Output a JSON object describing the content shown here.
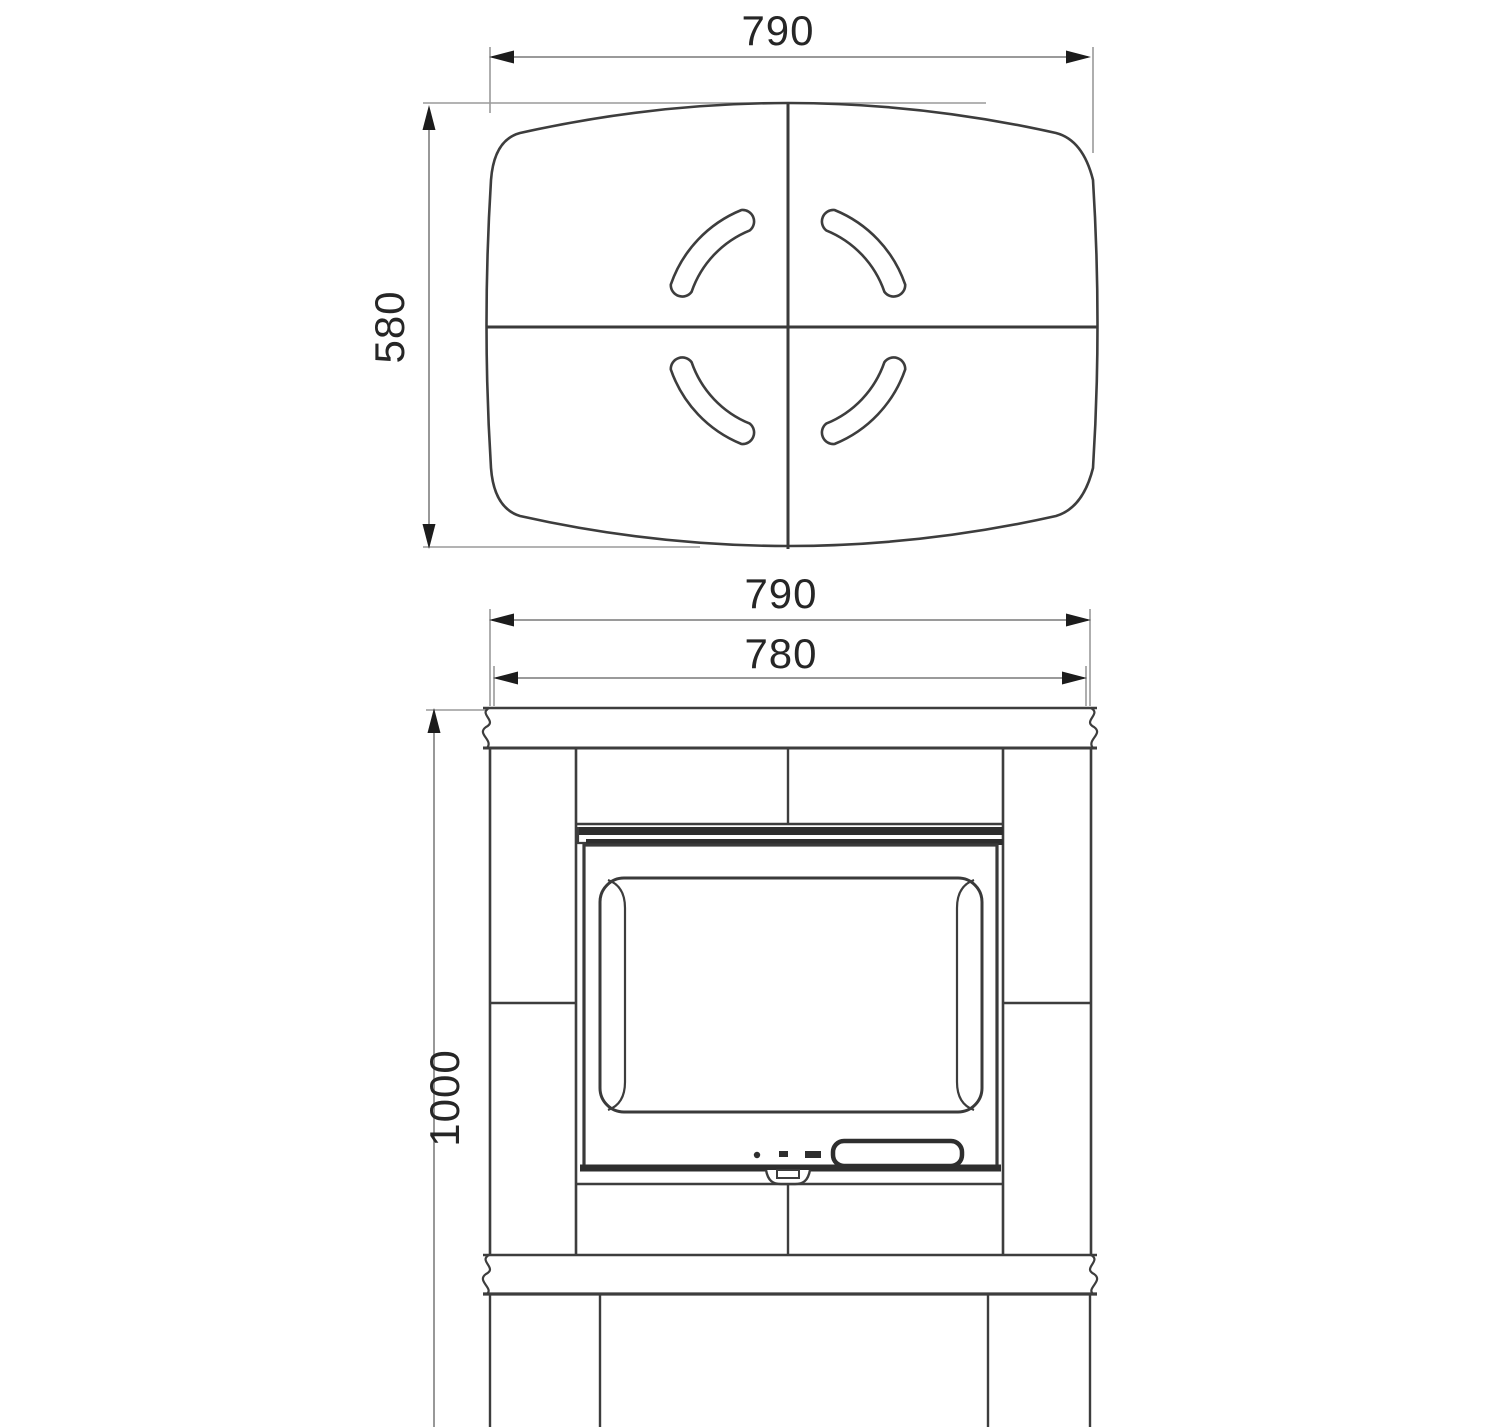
{
  "top_view": {
    "width": "790",
    "depth": "580"
  },
  "front_view": {
    "top_width": "790",
    "body_width": "780",
    "height": "1000"
  }
}
